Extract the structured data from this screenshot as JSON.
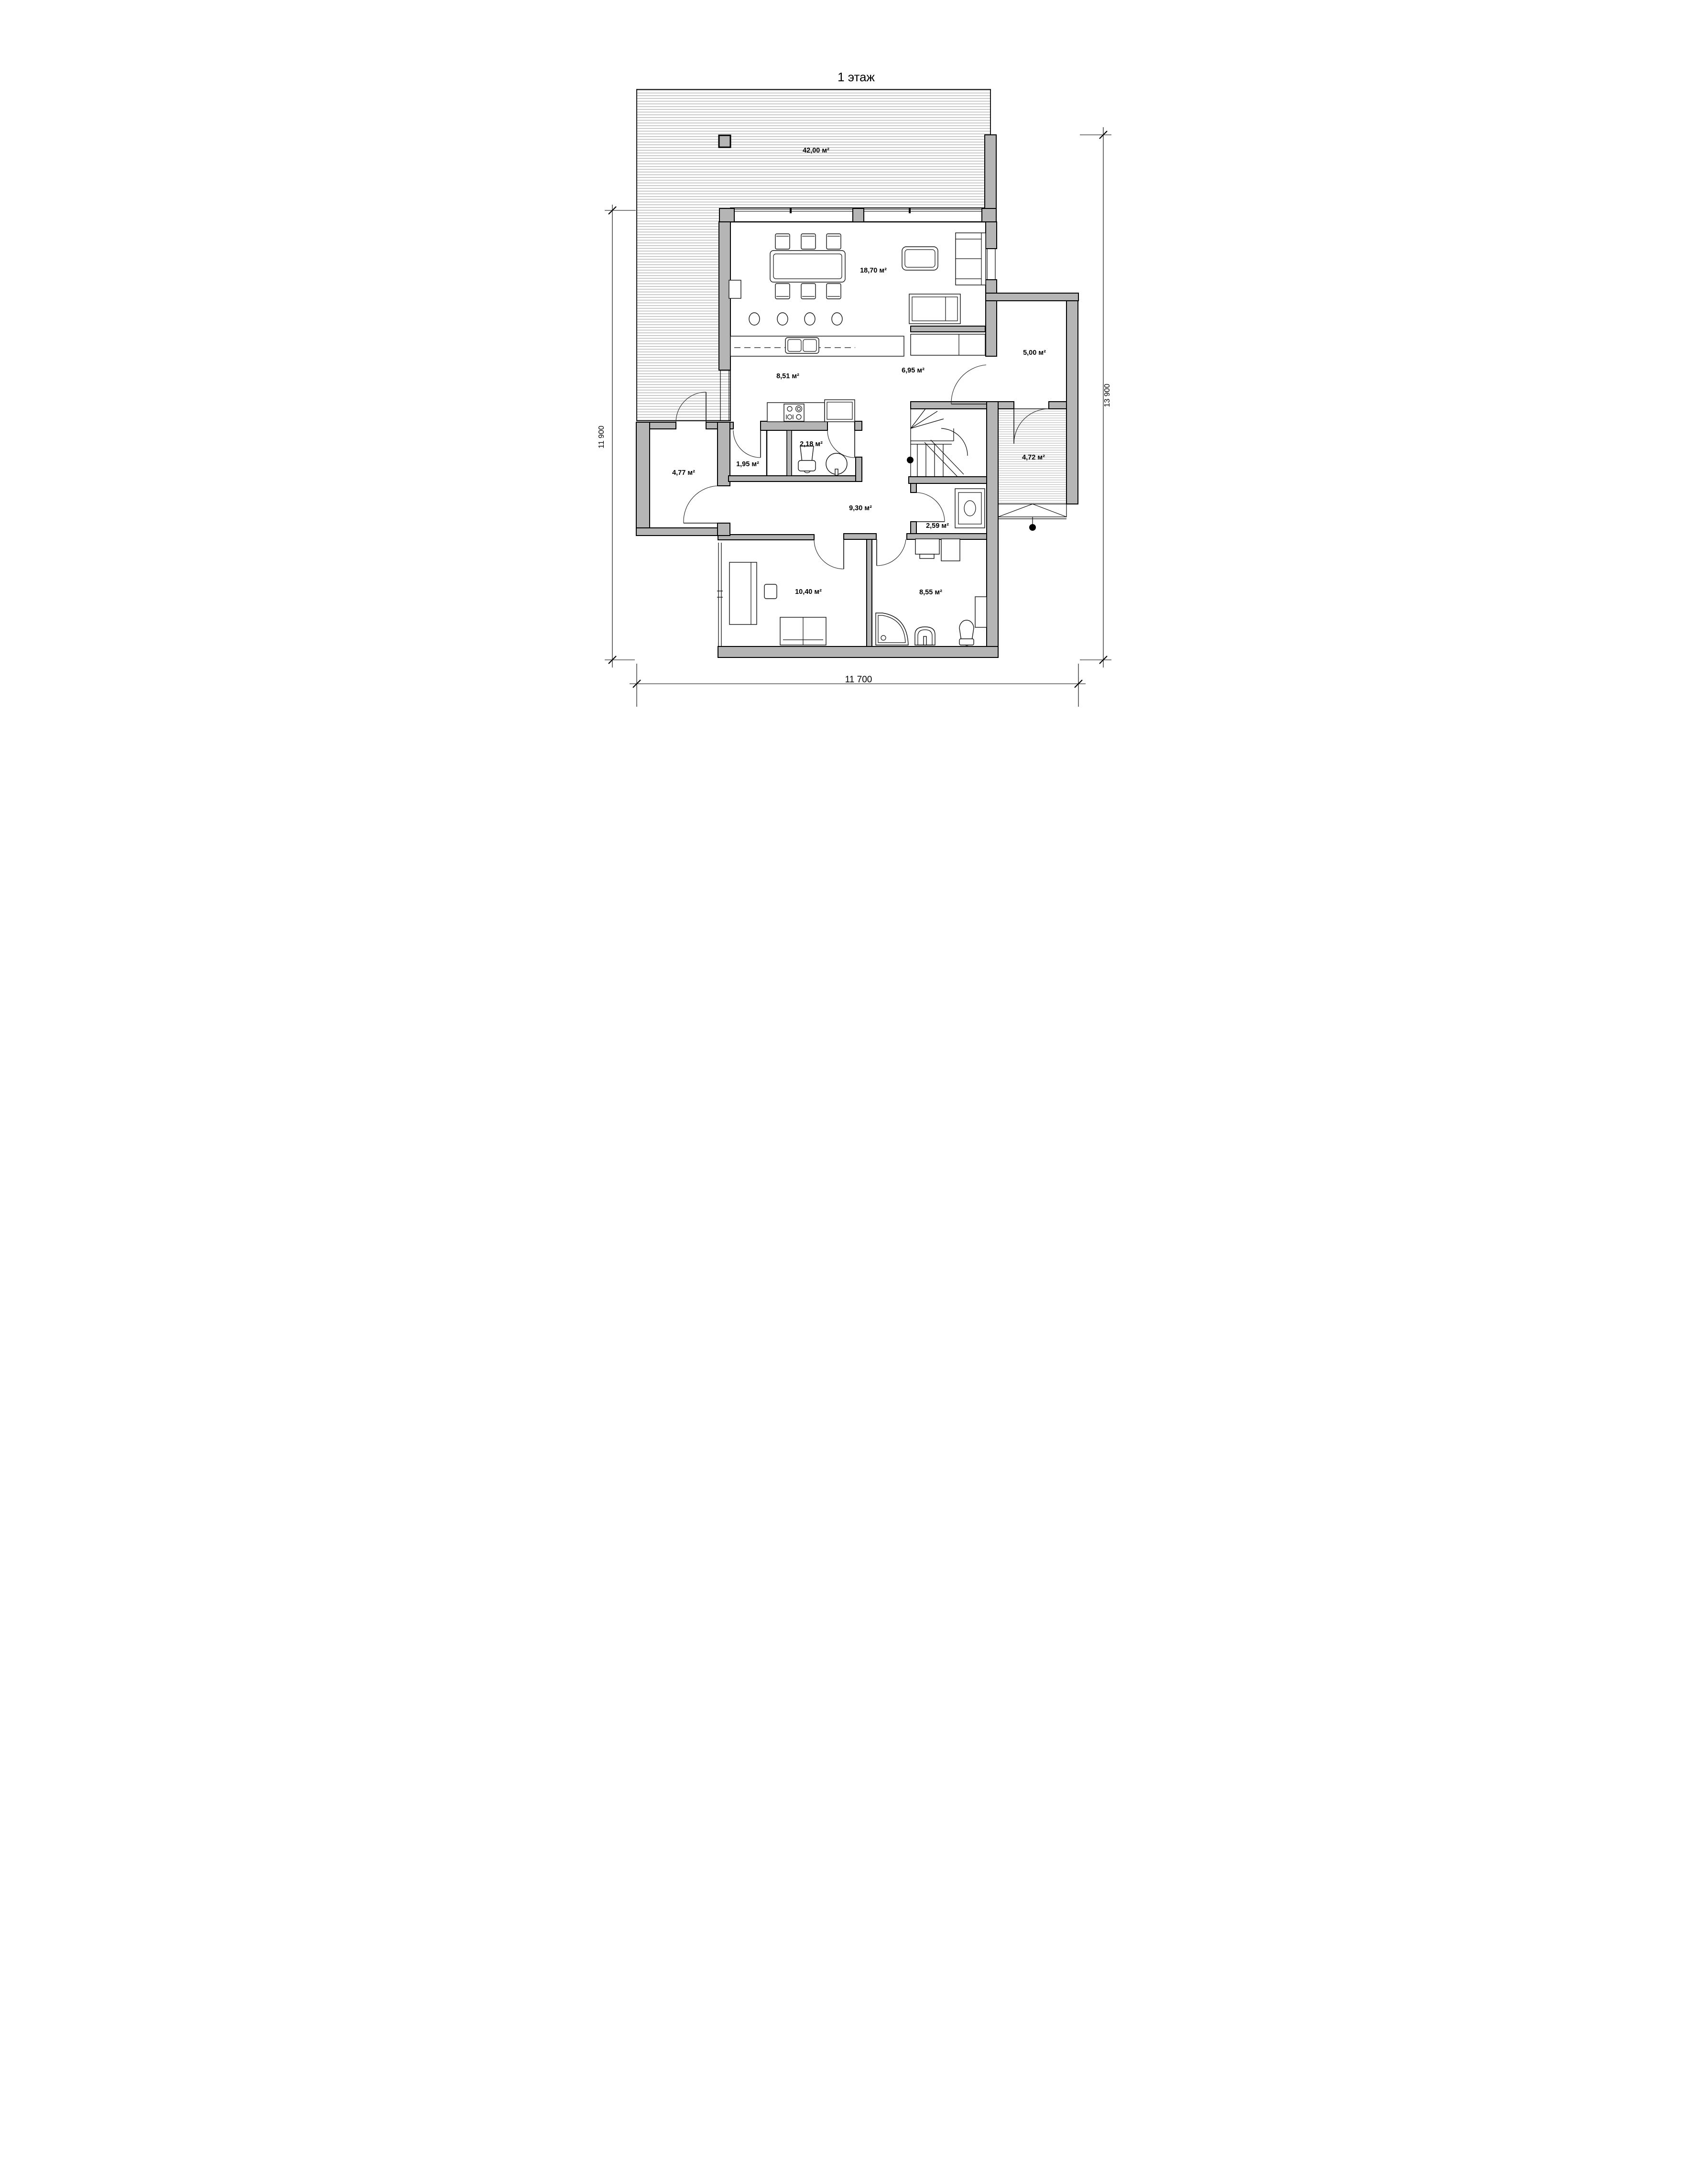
{
  "title": {
    "text": "1 этаж"
  },
  "colors": {
    "wall_fill": "#b5b5b5",
    "line": "#000000",
    "terrace_hatch": "#a8a8a8",
    "vestibule_hatch": "#b0b0b0"
  },
  "rooms": {
    "terrace": {
      "name": "terrace",
      "area": "42,00 м²"
    },
    "living": {
      "name": "living-dining",
      "area": "18,70 м²"
    },
    "kitchen": {
      "name": "kitchen",
      "area": "8,51 м²"
    },
    "hall_inner": {
      "name": "inner-hall",
      "area": "6,95 м²"
    },
    "pantry": {
      "name": "pantry",
      "area": "5,00 м²"
    },
    "wc": {
      "name": "wc",
      "area": "2,18 м²"
    },
    "hall_small": {
      "name": "small-hall",
      "area": "1,95 м²"
    },
    "storage": {
      "name": "storage",
      "area": "4,77 м²"
    },
    "vestibule": {
      "name": "entry-vestibule",
      "area": "4,72 м²"
    },
    "hallway": {
      "name": "hallway",
      "area": "9,30 м²"
    },
    "boiler": {
      "name": "boiler-room",
      "area": "2,59 м²"
    },
    "bedroom": {
      "name": "bedroom-office",
      "area": "10,40 м²"
    },
    "bathroom": {
      "name": "bathroom",
      "area": "8,55 м²"
    }
  },
  "dimensions": {
    "left": "11 900",
    "right": "13 900",
    "bottom": "11 700"
  }
}
